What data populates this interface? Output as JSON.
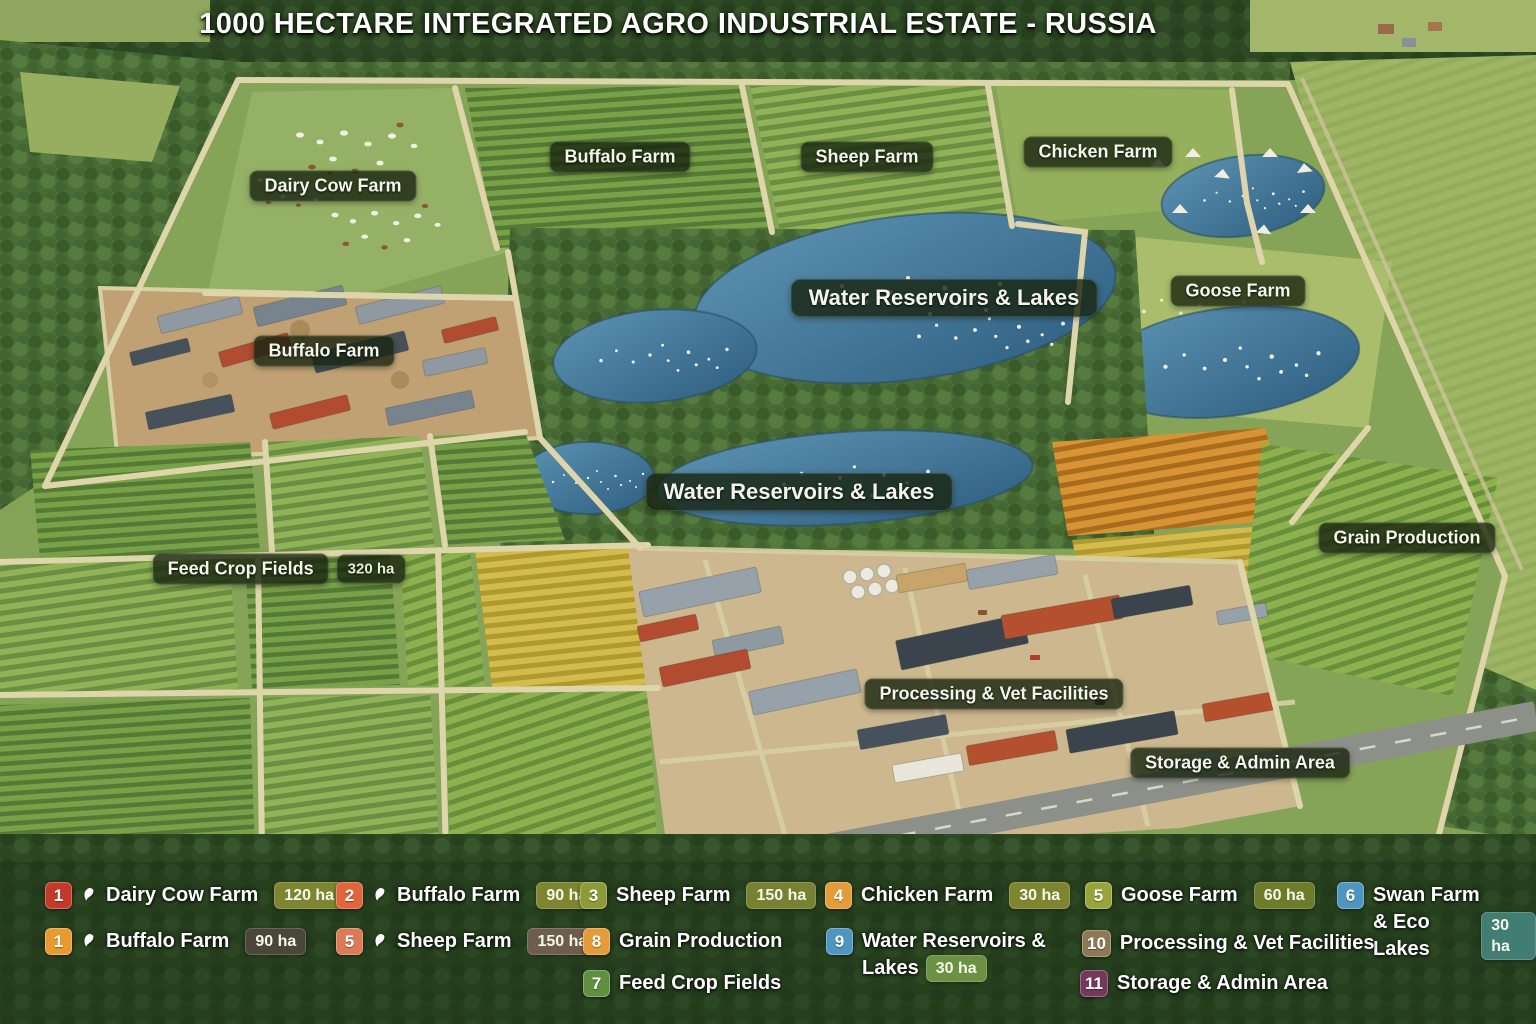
{
  "title": "1000 HECTARE INTEGRATED AGRO INDUSTRIAL ESTATE - RUSSIA",
  "map_labels": {
    "dairy_cow": {
      "text": "Dairy Cow Farm"
    },
    "buffalo_top": {
      "text": "Buffalo Farm"
    },
    "sheep": {
      "text": "Sheep Farm"
    },
    "chicken": {
      "text": "Chicken Farm"
    },
    "water_upper": {
      "text": "Water Reservoirs & Lakes"
    },
    "goose": {
      "text": "Goose Farm"
    },
    "buffalo_left": {
      "text": "Buffalo Farm"
    },
    "water_lower": {
      "text": "Water Reservoirs & Lakes"
    },
    "grain": {
      "text": "Grain Production"
    },
    "feed": {
      "text": "Feed Crop Fields",
      "badge": "320 ha"
    },
    "processing": {
      "text": "Processing & Vet Facilities"
    },
    "storage": {
      "text": "Storage & Admin Area"
    }
  },
  "legend": {
    "items": [
      {
        "number": "1",
        "number_color": "#c23b2a",
        "icon": "dairy-cow",
        "label": "Dairy Cow Farm",
        "area": "120 ha",
        "area_color": "#7d8530"
      },
      {
        "number": "2",
        "number_color": "#e0653b",
        "icon": "buffalo",
        "label": "Buffalo Farm",
        "area": "90 ha",
        "area_color": "#7d8530"
      },
      {
        "number": "3",
        "number_color": "#8d9b37",
        "label": "Sheep Farm",
        "area": "150 ha",
        "area_color": "#768231"
      },
      {
        "number": "4",
        "number_color": "#e49c3b",
        "label": "Chicken Farm",
        "area": "30 ha",
        "area_color": "#7d8530"
      },
      {
        "number": "5",
        "number_color": "#97a43c",
        "label": "Goose Farm",
        "area": "60 ha",
        "area_color": "#6d7c2b"
      },
      {
        "number": "6",
        "number_color": "#4f95c2",
        "label_line1": "Swan Farm",
        "label_line2": "& Eco Lakes",
        "area": "30 ha",
        "area_color": "#417d73"
      },
      {
        "number": "1",
        "number_color": "#e79b2e",
        "icon": "buffalo",
        "label": "Buffalo Farm",
        "area": "90 ha",
        "area_color": "#4b453a"
      },
      {
        "number": "5",
        "number_color": "#dc7a55",
        "icon": "sheep",
        "label": "Sheep Farm",
        "area": "150 ha",
        "area_color": "#6e5d4a"
      },
      {
        "number": "8",
        "number_color": "#e49c3b",
        "label": "Grain Production"
      },
      {
        "number": "9",
        "number_color": "#4f95c2",
        "label_line1": "Water Reservoirs &",
        "label_line2": "Lakes",
        "area": "30 ha",
        "area_color": "#6c9144"
      },
      {
        "number": "10",
        "number_color": "#8b7a54",
        "label": "Processing & Vet Facilities"
      },
      {
        "number": "7",
        "number_color": "#5e9040",
        "label": "Feed Crop Fields"
      },
      {
        "number": "11",
        "number_color": "#74395a",
        "label": "Storage & Admin Area"
      }
    ]
  }
}
